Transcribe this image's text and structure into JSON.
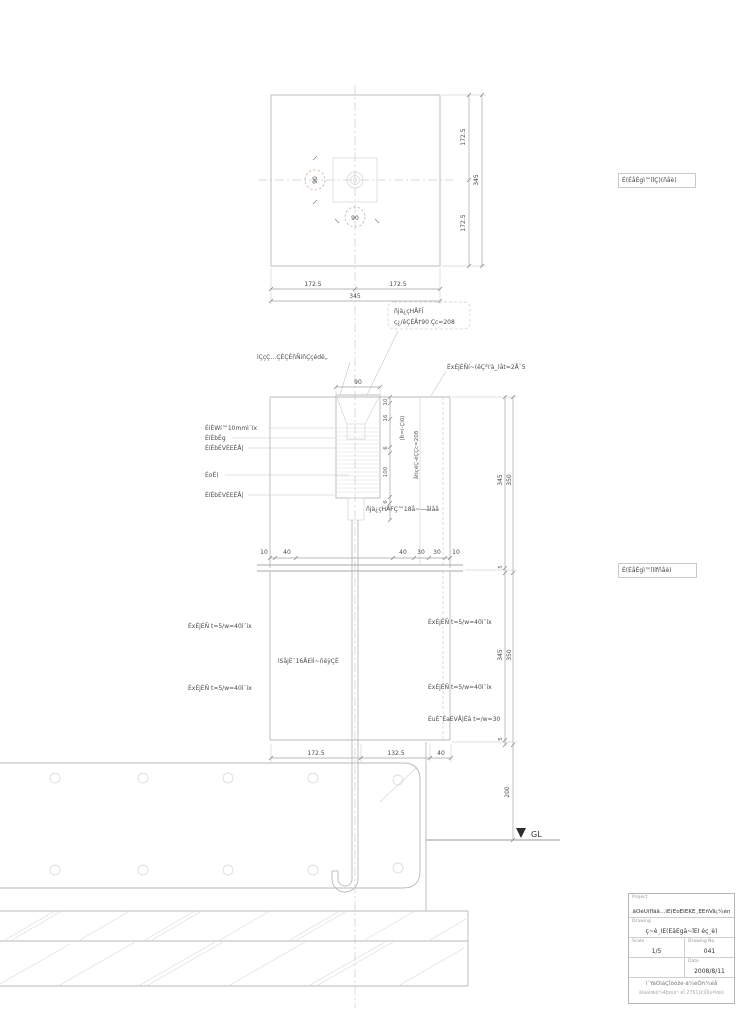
{
  "colors": {
    "line": "#b9b9b9",
    "accent_dash_circle": "#cdb0a0",
    "text": "#4a4a4a"
  },
  "plan": {
    "label_box": "É(ÉåÉgì™îlÇ)(ñåè)",
    "right_dims": [
      "172.5",
      "172.5"
    ],
    "right_total": "345",
    "bottom_dims": [
      "172.5",
      "172.5"
    ],
    "bottom_total": "345",
    "circle_dims": [
      "90",
      "90"
    ]
  },
  "callout": {
    "line1": "ñjà¿çHÅFÎ",
    "line2": "ç¿/êÇÉÅ†90 Çc=208"
  },
  "section": {
    "label_box": "É(ÉåÉgì™îlífñåè)",
    "annot_top_left": "ìÇçÇ…ÇÉÇÉñÑíñÇçédë„",
    "annot_top_right": "ÉxÉjÉÑí~(êÇ²ì'à_)åt=2Å`5",
    "left_notes": [
      "ÉíÉWí™10mmì¨íx",
      "ÉíÉbÉg",
      "ÉíÉbÉVÉEÉÅ|",
      "ÉoÉ)",
      "ÉíÉbÉVÉEÉÅ|"
    ],
    "post_dim_top": "90",
    "small_dims": [
      "10",
      "16",
      "6",
      "100",
      "6"
    ],
    "rotated_note_inner": "(Ît=í-Çì0)",
    "rotated_note_outer": "åtìçêÇ-êÇÇc=208",
    "anchor_note": "ñjà¿çHÅFÇ™18å~—ålåå",
    "dims_row": [
      "10",
      "40",
      "40",
      "30",
      "30",
      "10"
    ],
    "veneer_left_1": "ÉxÉjÉÑ t=5/w=40ì¨íx",
    "veneer_left_2": "ÉxÉjÉÑ t=5/w=40ì¨íx",
    "center_note": "ìSåjÉ¨16ÅEÌÌ~ñéÿÇÉ",
    "veneer_right_1": "ÉxÉjÉÑ t=5/w=40ì¨íx",
    "veneer_right_2": "ÉxÉjÉÑ t=5/w=40ì¨íx",
    "plate_note": "ÉuÉ˘ÉaÉVÅ|Éå t=/w=30",
    "right_chain_inner": [
      "345",
      "5",
      "345",
      "5"
    ],
    "right_chain_outer": [
      "350",
      "350"
    ],
    "dim_200": "200",
    "dims_bottom": [
      "172.5",
      "132.5",
      "40"
    ]
  },
  "ground": {
    "gl_label": "GL"
  },
  "titleblock": {
    "project_label": "Project",
    "project_value": "äÒéUìfläå…ìÉ(ÉoÉÎÉKÉ¸ÉÉñVå¡¼én",
    "drawing_label": "Drawing",
    "drawing_value": "ç~è¸ÎÉ(ÉåÉgå~îÉÎ éç¸è)",
    "scale_label": "Scale",
    "scale_value": "1/5",
    "no_label": "Drawing No.",
    "no_value": "041",
    "date_label": "Date",
    "date_value": "2008/8/11",
    "footer_line1": "ì˜YäÒìáÇÎôòžé·ä¼éÒñ¼éå",
    "footer_line2": "älaaìœè¼4þour¹ éÎ 2761(k)Îßúªìœù"
  }
}
